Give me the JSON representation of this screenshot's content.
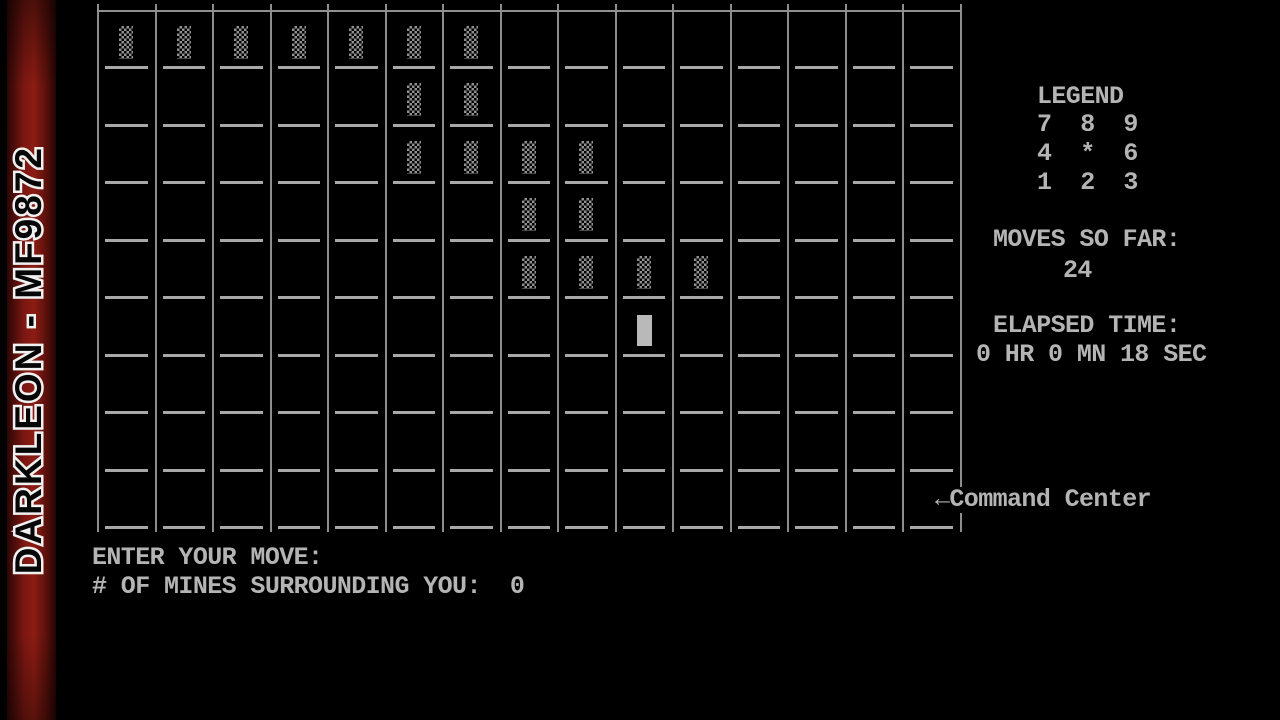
{
  "window": {
    "watermark": "DARKLEON - MF9872"
  },
  "colors": {
    "background": "#000000",
    "grid_line": "#8d8d8d",
    "grid_dash": "#a8a8a8",
    "text": "#b4b4b4",
    "wall_texture": "#919191",
    "player_block": "#b9b9b9",
    "strip_red": "#8c1c13"
  },
  "grid": {
    "cols": 15,
    "rows": 9,
    "walls": [
      [
        0,
        0
      ],
      [
        0,
        1
      ],
      [
        0,
        2
      ],
      [
        0,
        3
      ],
      [
        0,
        4
      ],
      [
        0,
        5
      ],
      [
        0,
        6
      ],
      [
        1,
        5
      ],
      [
        1,
        6
      ],
      [
        2,
        5
      ],
      [
        2,
        6
      ],
      [
        2,
        7
      ],
      [
        2,
        8
      ],
      [
        3,
        7
      ],
      [
        3,
        8
      ],
      [
        4,
        7
      ],
      [
        4,
        8
      ],
      [
        4,
        9
      ],
      [
        4,
        10
      ]
    ],
    "player": [
      5,
      9
    ]
  },
  "legend": {
    "title": "LEGEND",
    "rows": [
      "7  8  9",
      "4  *  6",
      "1  2  3"
    ]
  },
  "stats": {
    "moves_label": "MOVES SO FAR:",
    "moves_value": "24",
    "elapsed_label": "ELAPSED TIME:",
    "elapsed_value": "0 HR 0 MN 18 SEC"
  },
  "annotations": {
    "command_center": "←Command Center"
  },
  "prompt": {
    "enter_move": "ENTER YOUR MOVE:",
    "mines_label": "# OF MINES SURROUNDING YOU:",
    "mines_value": "0"
  }
}
